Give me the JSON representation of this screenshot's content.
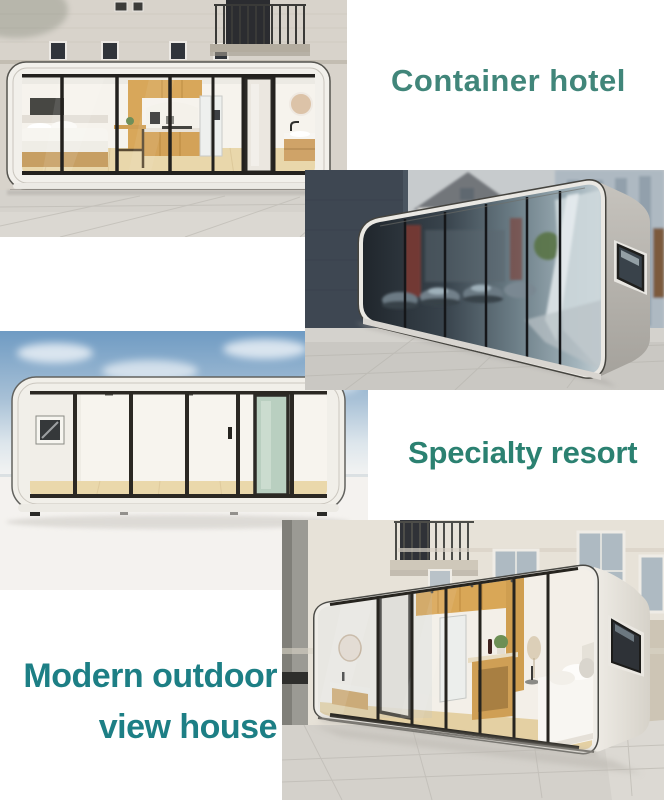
{
  "page": {
    "background": "#ffffff",
    "width": 664,
    "height": 800
  },
  "captions": {
    "container_hotel": "Container hotel",
    "specialty_resort": "Specialty resort",
    "modern_outdoor_line1": "Modern outdoor",
    "modern_outdoor_line2": "view house"
  },
  "caption_colors": {
    "container_hotel": "#41867a",
    "specialty_resort": "#2b8171",
    "modern_outdoor": "#1d7f85"
  },
  "photos": {
    "top_left": "container cabin with glass front showing bed, kitchen and bathroom against a classic building facade",
    "middle_right": "container pod with dark mirrored glass reflecting street, cars, red buildings and a tree",
    "middle_left": "empty container pod with glass front, wood floor and green door under a blue sky",
    "bottom_right": "angled container home with glass front showing bathroom, kitchen and bed beside a building"
  }
}
